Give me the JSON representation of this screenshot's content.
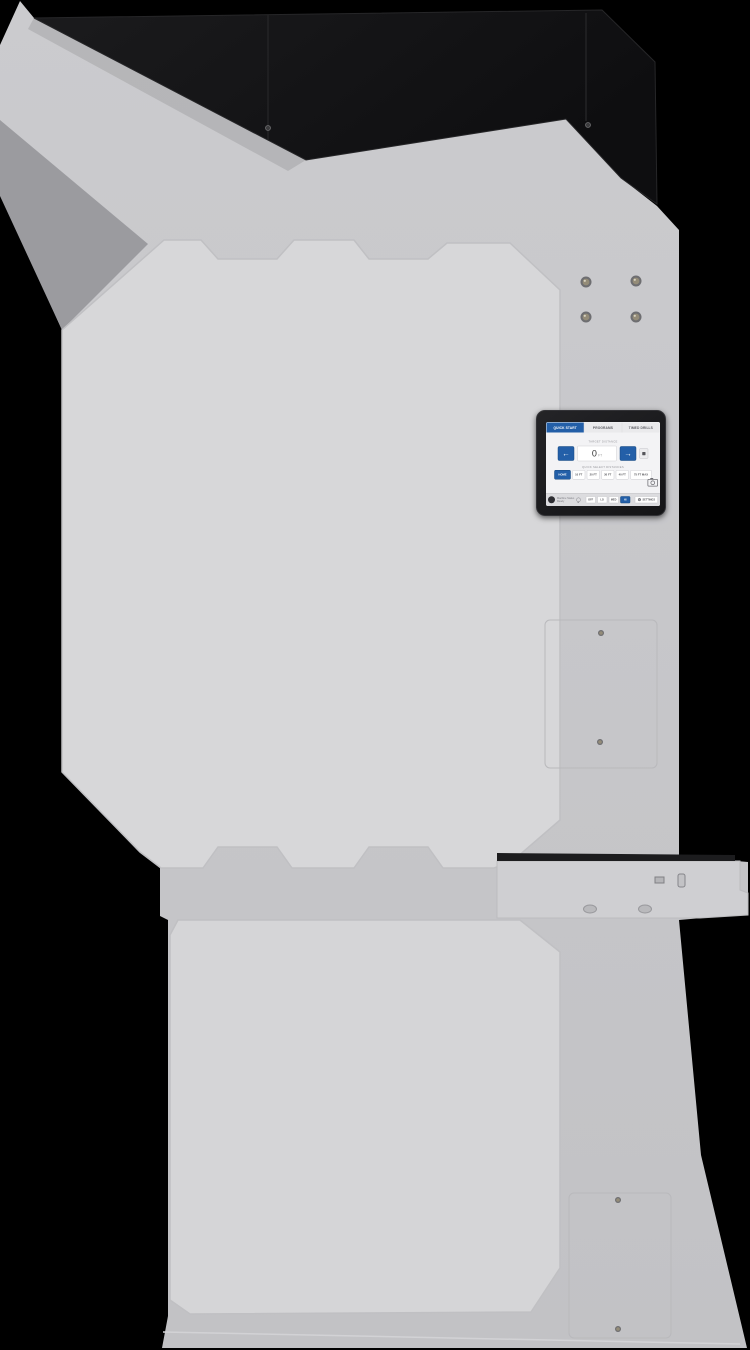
{
  "colors": {
    "background": "#000000",
    "machine_body": "#c6c6c9",
    "machine_panel": "#d7d7d9",
    "hood_black": "#131313",
    "accent_blue": "#235fa8"
  },
  "screen": {
    "tabs": [
      {
        "label": "QUICK START",
        "active": true
      },
      {
        "label": "PROGRAMS",
        "active": false
      },
      {
        "label": "TIMED DRILLS",
        "active": false
      }
    ],
    "target": {
      "label": "TARGET DISTANCE",
      "value": "0",
      "unit": "FT"
    },
    "icons": {
      "left_arrow": "←",
      "right_arrow": "→",
      "gear": "⚙"
    },
    "quick": {
      "label": "QUICK SELECT DISTANCES",
      "options": [
        "HOME",
        "10 FT",
        "20 FT",
        "30 FT",
        "40 FT",
        "75 FT MAX"
      ]
    },
    "status": {
      "line1": "Machine Status",
      "line2": "Ready",
      "light_buttons": [
        "OFF",
        "LO",
        "MED",
        "HI"
      ],
      "settings_label": "SETTINGS"
    }
  }
}
